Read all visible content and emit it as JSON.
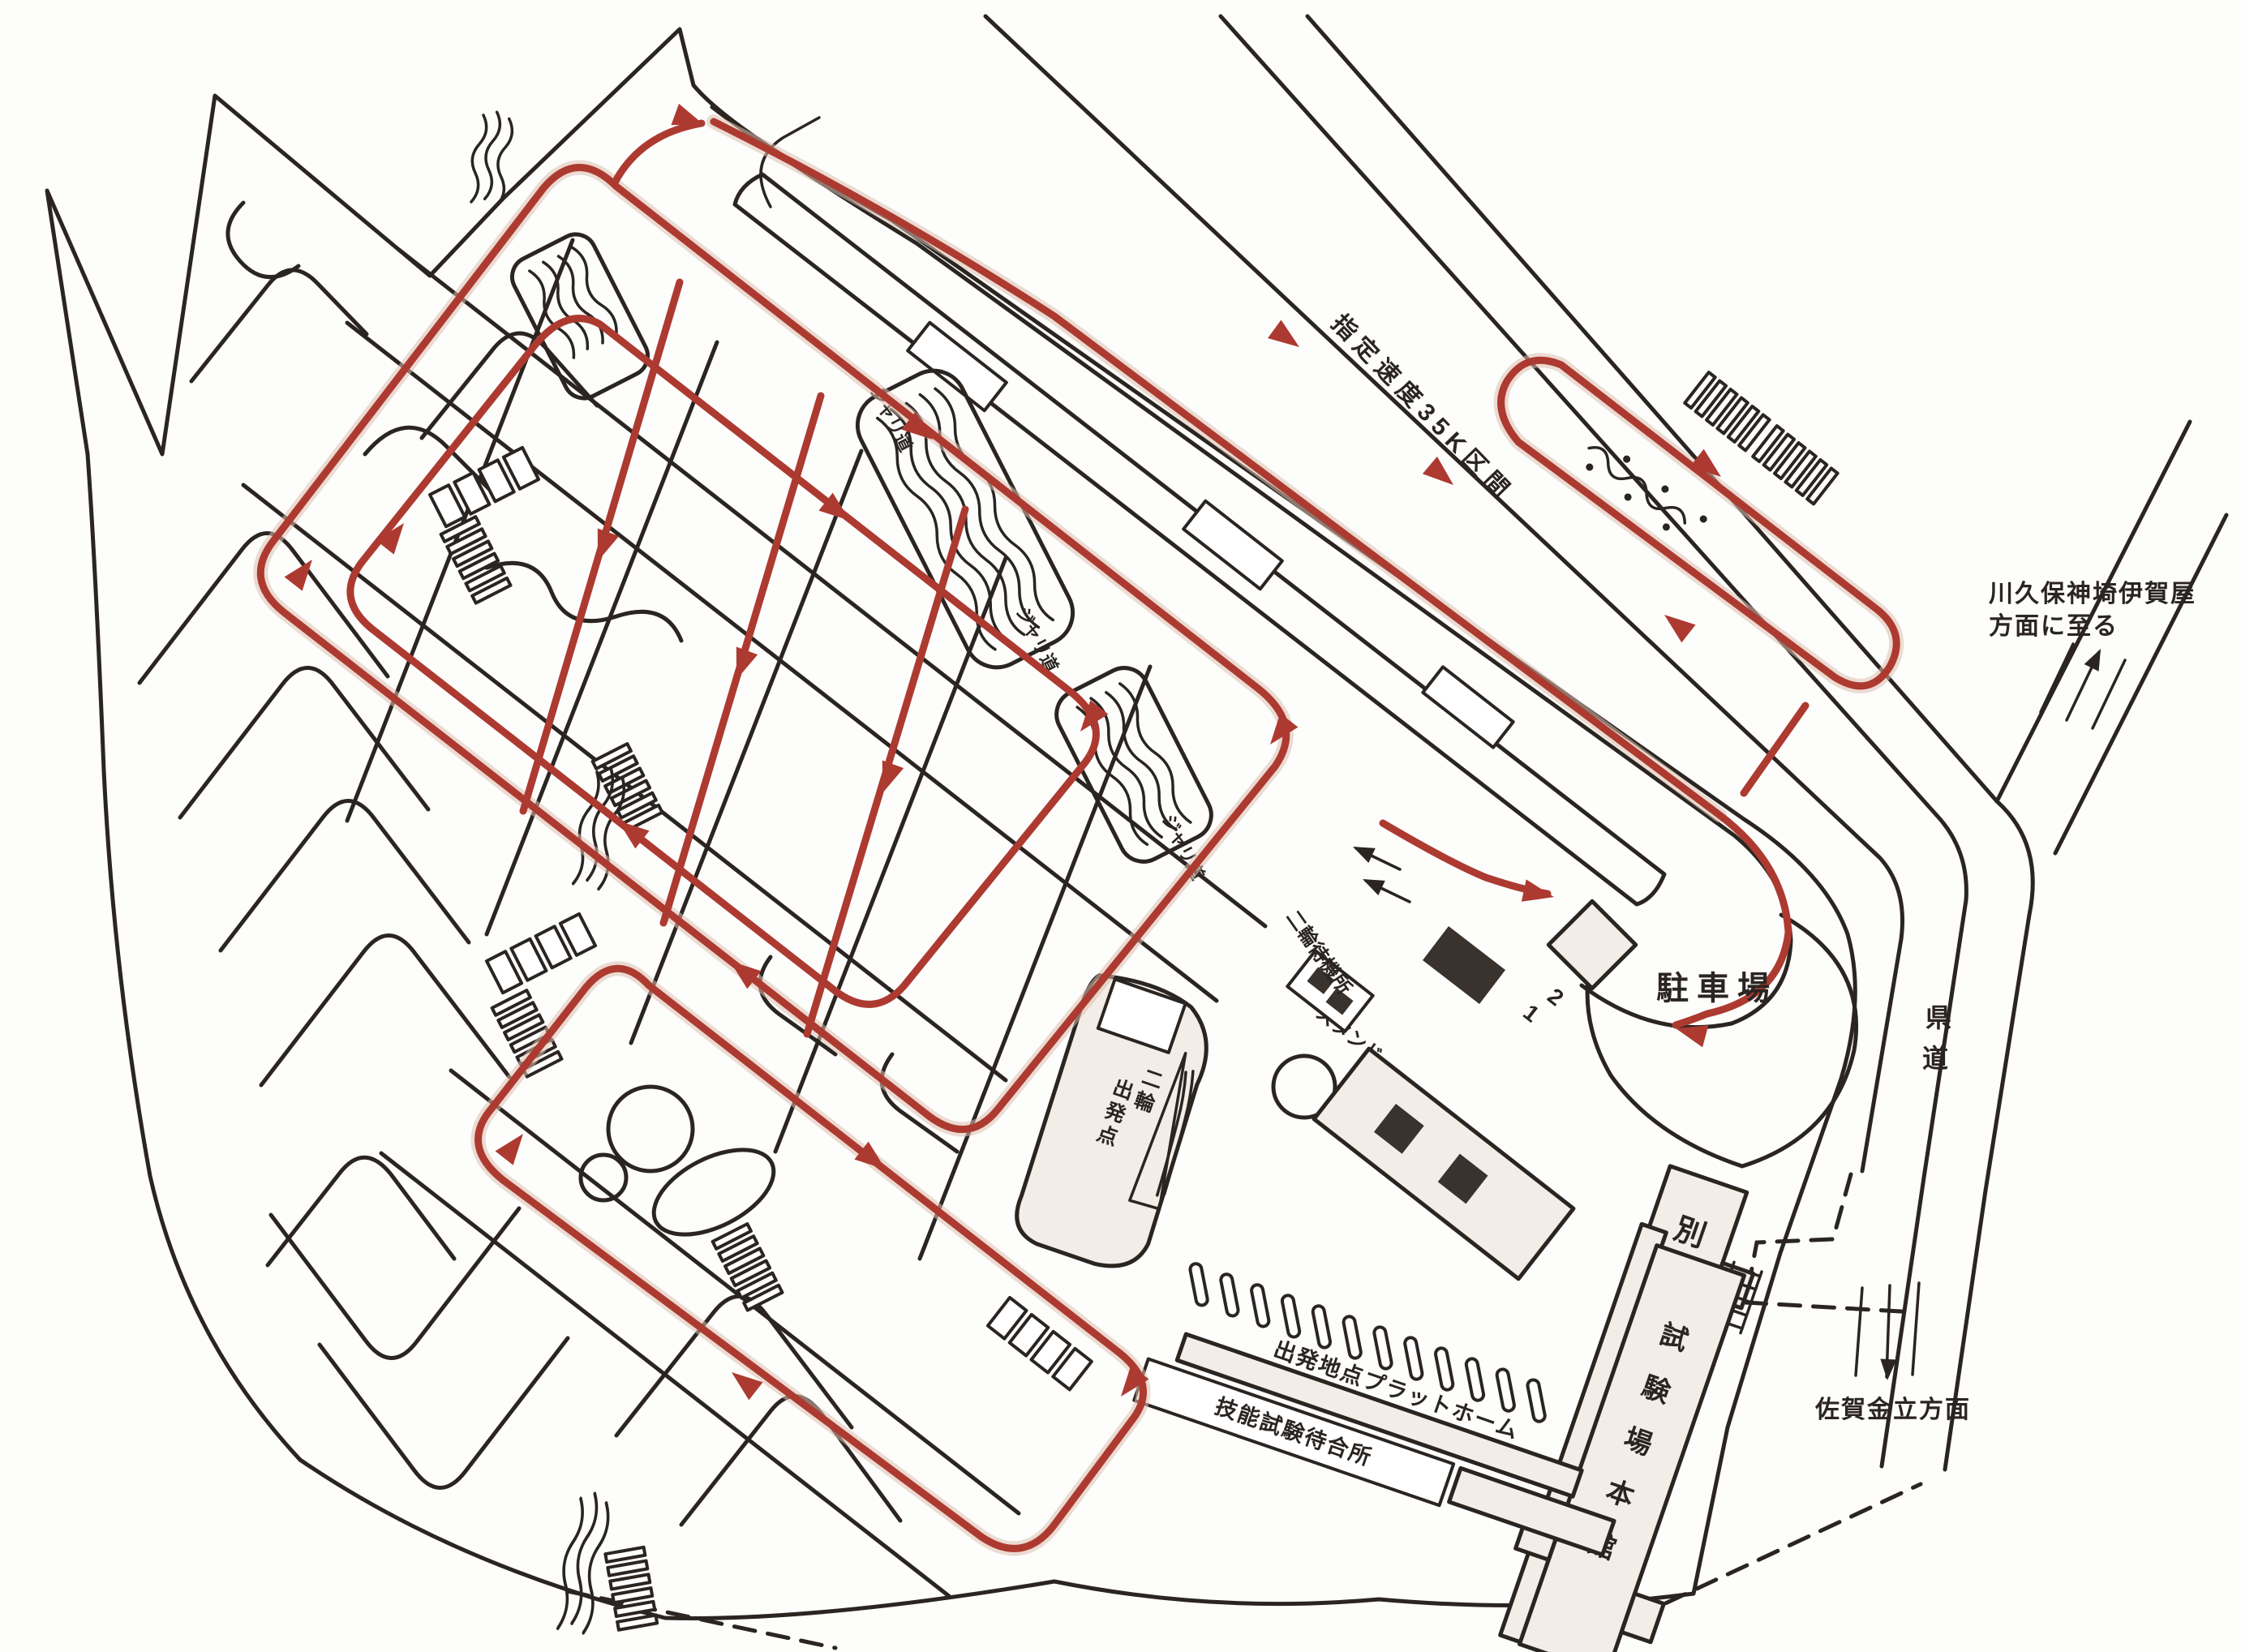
{
  "map": {
    "labels": {
      "speed_section": "指定速度35K区間",
      "north_dir_line1": "川久保神埼伊賀屋",
      "north_dir_line2": "方面に至る",
      "pref_road_chars": [
        "県",
        "道"
      ],
      "south_dir": "佐賀金立方面",
      "parking": "駐車場",
      "annex_chars": [
        "別",
        "館"
      ],
      "main_hall_chars": [
        "試",
        "験",
        "場",
        "本",
        "館"
      ],
      "platform": "出発地点プラットホーム",
      "waiting": "技能試験待合所",
      "stand": "スタンド",
      "moto_right_chars": [
        "二",
        "輪"
      ],
      "moto_left_chars": [
        "出",
        "発",
        "点"
      ],
      "moto_wait": "二輪待機所",
      "gravel": "ジャリ道",
      "lane1": "1",
      "lane2": "2"
    },
    "colors": {
      "ink": "#2b2522",
      "route_red": "#ad3a30",
      "light_fill": "#f2ede7",
      "dark_fill": "#3a322d",
      "paper": "#ffffff"
    }
  }
}
